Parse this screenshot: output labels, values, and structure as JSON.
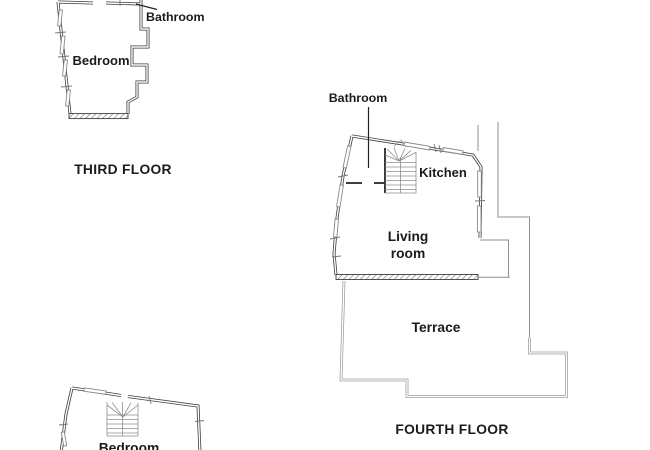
{
  "colors": {
    "background": "#ffffff",
    "wall": "#3d3d3d",
    "thin_line": "#8f8f8f",
    "terrace_line": "#9c9c9c",
    "text": "#1b1b1b"
  },
  "third_floor": {
    "title": "THIRD FLOOR",
    "labels": {
      "bathroom": "Bathroom",
      "bedroom": "Bedroom"
    }
  },
  "fourth_floor": {
    "title": "FOURTH FLOOR",
    "labels": {
      "bathroom": "Bathroom",
      "kitchen": "Kitchen",
      "living_room": [
        "Living",
        "room"
      ],
      "terrace": "Terrace"
    }
  },
  "lower_floor_partial": {
    "labels": {
      "bedroom": "Bedroom"
    }
  }
}
